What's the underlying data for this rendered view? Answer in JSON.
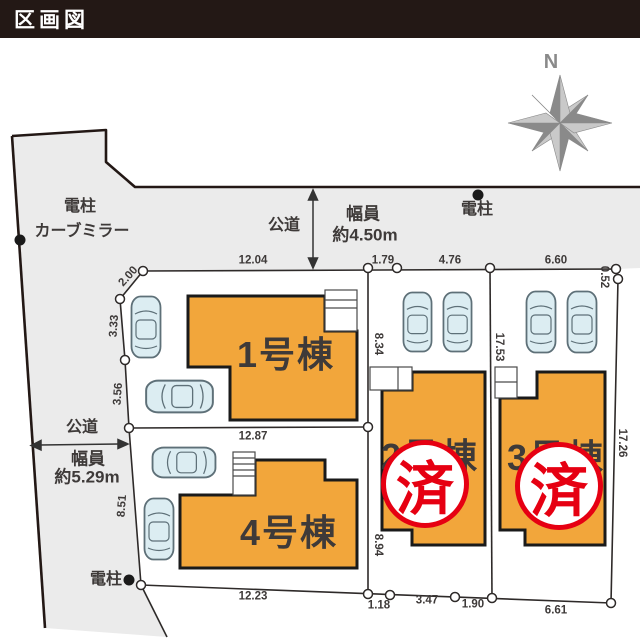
{
  "title": "区画図",
  "compass": {
    "north_label": "N"
  },
  "roads": {
    "top": {
      "label": "公道",
      "width_line1": "幅員",
      "width_line2": "約4.50m"
    },
    "left": {
      "label": "公道",
      "width_line1": "幅員",
      "width_line2": "約5.29m"
    }
  },
  "landmarks": {
    "pole_top_right": "電柱",
    "pole_left": "電柱",
    "curve_mirror": "カーブミラー",
    "pole_bottom": "電柱"
  },
  "lots": [
    {
      "building_label": "1号棟",
      "status": "available"
    },
    {
      "building_label": "2号棟",
      "status": "sold",
      "stamp_label": "済"
    },
    {
      "building_label": "3号棟",
      "status": "sold",
      "stamp_label": "済"
    },
    {
      "building_label": "4号棟",
      "status": "available"
    }
  ],
  "dimensions": {
    "top_main": "12.04",
    "top_a": "1.79",
    "top_b": "4.76",
    "top_c": "6.60",
    "top_jog": "0.52",
    "left_1": "2.00",
    "left_2": "3.33",
    "left_3": "3.56",
    "left_4": "8.51",
    "mid_split": "12.87",
    "lot1_right": "8.34",
    "lot2_right": "17.53",
    "lot4_right": "8.94",
    "right_edge": "17.26",
    "bottom_1": "12.23",
    "bottom_2": "1.18",
    "bottom_3": "3.47",
    "bottom_4": "1.90",
    "bottom_5": "6.61"
  },
  "colors": {
    "building": "#F2A63B",
    "stamp_red": "#E60012",
    "road_gray": "#EBEBEB",
    "title_bg": "#231815",
    "line_dark": "#333333",
    "car_fill": "#DCEDF2"
  }
}
